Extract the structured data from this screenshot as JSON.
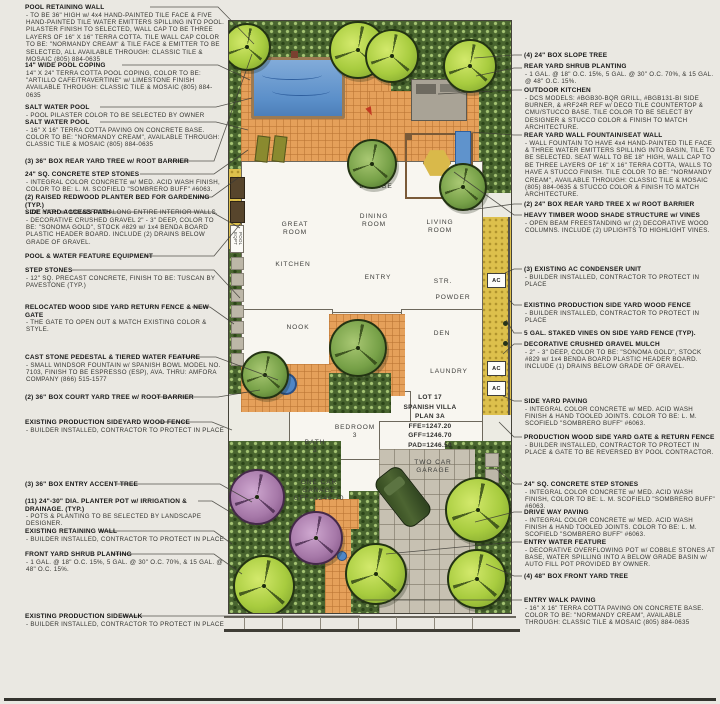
{
  "colors": {
    "paper": "#eae8e2",
    "ink": "#2b2b2b",
    "pool_blue": "#5b8fc9",
    "terra_cotta": "#e5a05a",
    "gravel_gold": "#ddc04c",
    "shrub_green": "#49652f",
    "tree_bright": "#a8cc3f",
    "tree_mid": "#76a047",
    "tree_purple": "#a678a8",
    "pave_gray": "#c7c1b2",
    "car_green": "#33491f"
  },
  "plan": {
    "rooms": {
      "great": "GREAT\nROOM",
      "lounge": "LOUNGE",
      "dining": "DINING\nROOM",
      "living": "LIVING\nROOM",
      "kitchen": "KITCHEN",
      "entry": "ENTRY",
      "stairs": "STR.",
      "powder": "POWDER",
      "nook": "NOOK",
      "den": "DEN",
      "laundry": "LAUNDRY",
      "bath": "BATH\n3",
      "bedroom": "BEDROOM\n3"
    },
    "lot_block": "LOT 17\nSPANISH VILLA\nPLAN 3A\nFFE=1247.20\nGFF=1246.70\nPAD=1246.50",
    "two_car": "TWO CAR\nGARAGE",
    "one_car": "ONE CAR\nGARAGE\nGFF=1246.70",
    "ac_label": "AC",
    "pool_eqpt_label": "POOL EQPT"
  },
  "left_annotations": [
    {
      "title": "POOL RETAINING WALL",
      "body": "- TO BE 36\" HIGH w/ 4x4 HAND-PAINTED TILE FACE & FIVE HAND-PAINTED TILE WATER EMITTERS SPILLING INTO POOL. PILASTER FINISH TO SELECTED, WALL CAP TO BE THREE LAYERS OF 16\" X 16\" TERRA COTTA. TILE WALL CAP COLOR TO BE: \"NORMANDY CREAM\" & TILE FACE & EMITTER TO BE SELECTED, ALL AVAILABLE THROUGH: CLASSIC TILE & MOSAIC (805) 884-0635"
    },
    {
      "title": "14\" WIDE POOL COPING",
      "body": "14\" X 24\" TERRA COTTA POOL COPING, COLOR TO BE: \"ARTILLO CAFE/TRAVERTINE\" w/ LIMESTONE FINISH AVAILABLE THROUGH: CLASSIC TILE & MOSAIC (805) 884-0635"
    },
    {
      "title": "SALT WATER POOL",
      "body": "- POOL PILASTER COLOR TO BE SELECTED BY OWNER"
    },
    {
      "title": "SALT WATER POOL",
      "body": "- 16\" X 16\" TERRA COTTA PAVING ON CONCRETE BASE. COLOR TO BE: \"NORMANDY CREAM\", AVAILABLE THROUGH: CLASSIC TILE & MOSAIC (805) 884-0635"
    },
    {
      "title": "(3) 36\" BOX REAR YARD TREE w/ ROOT BARRIER",
      "body": ""
    },
    {
      "title": "24\" SQ. CONCRETE STEP STONES",
      "body": "- INTEGRAL COLOR CONCRETE w/ MED. ACID WASH FINISH, COLOR TO BE: L. M. SCOFIELD \"SOMBRERO BUFF\" #6063."
    },
    {
      "title": "(2) RAISED REDWOOD PLANTER BED FOR GARDENING (TYP.)",
      "body": "- 24\" HIGH w/ MIRADRAIN ALONG ENTIRE INTERIOR WALLS."
    },
    {
      "title": "SIDE YARD ACCESS PATH",
      "body": "- DECORATIVE CRUSHED GRAVEL 2\" - 3\" DEEP, COLOR TO BE: \"SONOMA GOLD\", STOCK #829 w/ 1x4 BENDA BOARD PLASTIC HEADER BOARD. INCLUDE (2) DRAINS BELOW GRADE OF GRAVEL."
    },
    {
      "title": "POOL & WATER FEATURE EQUIPMENT",
      "body": ""
    },
    {
      "title": "STEP STONES",
      "body": "- 12\" SQ. PRECAST CONCRETE, FINISH TO BE: TUSCAN BY PAVESTONE (TYP.)"
    },
    {
      "title": "RELOCATED WOOD SIDE YARD RETURN FENCE & NEW GATE",
      "body": "- THE GATE TO OPEN OUT & MATCH EXISTING COLOR & STYLE."
    },
    {
      "title": "CAST STONE PEDESTAL & TIERED WATER FEATURE",
      "body": "- SMALL WINDSOR FOUNTAIN w/ SPANISH BOWL MODEL NO. 7103, FINISH TO BE ESPRESSO (ESP), AVA. THRU: AMFORA COMPANY (866) 515-1577"
    },
    {
      "title": "(2) 36\" BOX COURT YARD TREE w/ ROOT BARRIER",
      "body": ""
    },
    {
      "title": "EXISTING PRODUCTION SIDEYARD WOOD FENCE",
      "body": "- BUILDER INSTALLED, CONTRACTOR TO PROTECT IN PLACE"
    },
    {
      "title": "(3) 36\" BOX ENTRY ACCENT TREE",
      "body": ""
    },
    {
      "title": "(11) 24\"-30\" DIA. PLANTER POT w/ IRRIGATION & DRAINAGE. (TYP.)",
      "body": "- POTS & PLANTING TO BE SELECTED BY LANDSCAPE DESIGNER."
    },
    {
      "title": "EXISTING RETAINING WALL",
      "body": "- BUILDER INSTALLED, CONTRACTOR TO PROTECT IN PLACE"
    },
    {
      "title": "FRONT YARD SHRUB PLANTING",
      "body": "- 1 GAL. @ 18\" O.C. 15%, 5 GAL. @ 30\" O.C. 70%, & 15 GAL. @ 48\" O.C. 15%."
    },
    {
      "title": "EXISTING PRODUCTION SIDEWALK",
      "body": "- BUILDER INSTALLED, CONTRACTOR TO PROTECT IN PLACE"
    }
  ],
  "right_annotations": [
    {
      "title": "(4) 24\" BOX SLOPE TREE",
      "body": ""
    },
    {
      "title": "REAR YARD SHRUB PLANTING",
      "body": "- 1 GAL. @ 18\" O.C. 15%, 5 GAL. @ 30\" O.C. 70%, & 15 GAL. @ 48\" O.C. 15%."
    },
    {
      "title": "OUTDOOR KITCHEN",
      "body": "- DCS MODELS: #BGB30-BQR GRILL, #BGB131-BI SIDE BURNER, & #RF24R REF w/ DECO TILE COUNTERTOP & CMU/STUCCO BASE. TILE COLOR TO BE SELECT BY DESIGNER & STUCCO COLOR & FINISH TO MATCH ARCHITECTURE."
    },
    {
      "title": "REAR YARD WALL FOUNTAIN/SEAT WALL",
      "body": "- WALL FOUNTAIN TO HAVE 4x4 HAND-PAINTED TILE FACE & THREE WATER EMITTERS SPILLING INTO BASIN, TILE TO BE SELECTED. SEAT WALL TO BE 18\" HIGH, WALL CAP TO BE THREE LAYERS OF 16\" X 16\" TERRA COTTA, WALLS TO HAVE A STUCCO FINISH. TILE COLOR TO BE: \"NORMANDY CREAM\", AVAILABLE THROUGH: CLASSIC TILE & MOSAIC (805) 884-0635 & STUCCO COLOR & FINISH TO MATCH ARCHITECTURE."
    },
    {
      "title": "(2) 24\" BOX REAR YARD TREE X w/ ROOT BARRIER",
      "body": ""
    },
    {
      "title": "HEAVY TIMBER WOOD SHADE STRUCTURE w/ VINES",
      "body": "- OPEN BEAM FREESTANDING w/ (2) DECORATIVE WOOD COLUMNS. INCLUDE (2) UPLIGHTS TO HIGHLIGHT VINES."
    },
    {
      "title": "(3) EXISTING AC CONDENSER UNIT",
      "body": "- BUILDER INSTALLED, CONTRACTOR TO PROTECT IN PLACE"
    },
    {
      "title": "EXISTING PRODUCTION SIDE YARD WOOD FENCE",
      "body": "- BUILDER INSTALLED, CONTRACTOR TO PROTECT IN PLACE"
    },
    {
      "title": "5 GAL. STAKED VINES ON SIDE YARD FENCE (TYP).",
      "body": ""
    },
    {
      "title": "DECORATIVE CRUSHED GRAVEL MULCH",
      "body": "- 2\" - 3\" DEEP, COLOR TO BE: \"SONOMA GOLD\", STOCK #829 w/ 1x4 BENDA BOARD PLASTIC HEADER BOARD. INCLUDE (1) DRAINS BELOW GRADE OF GRAVEL."
    },
    {
      "title": "SIDE YARD PAVING",
      "body": "- INTEGRAL COLOR CONCRETE w/ MED. ACID WASH FINISH & HAND TOOLED JOINTS. COLOR TO BE: L. M. SCOFIELD \"SOMBRERO BUFF\" #6063."
    },
    {
      "title": "PRODUCTION WOOD SIDE YARD GATE & RETURN FENCE",
      "body": "- BUILDER INSTALLED, CONTRACTOR TO PROTECT IN PLACE & GATE TO BE REVERSED BY POOL CONTRACTOR."
    },
    {
      "title": "24\" SQ. CONCRETE STEP STONES",
      "body": "- INTEGRAL COLOR CONCRETE w/ MED. ACID WASH FINISH, COLOR TO BE: L. M. SCOFIELD \"SOMBRERO BUFF\" #6063."
    },
    {
      "title": "DRIVE WAY PAVING",
      "body": "- INTEGRAL COLOR CONCRETE w/ MED. ACID WASH FINISH & HAND TOOLED JOINTS. COLOR TO BE: L. M. SCOFIELD \"SOMBRERO BUFF\" #6063."
    },
    {
      "title": "ENTRY WATER FEATURE",
      "body": "- DECORATIVE OVERFLOWING POT w/ COBBLE STONES AT BASE, WATER SPILLING INTO A BELOW GRADE BASIN w/ AUTO FILL POT PROVIDED BY OWNER."
    },
    {
      "title": "(4) 48\" BOX FRONT YARD TREE",
      "body": ""
    },
    {
      "title": "ENTRY WALK PAVING",
      "body": "- 16\" X 16\" TERRA COTTA PAVING ON CONCRETE BASE. COLOR TO BE: \"NORMANDY CREAM\", AVAILABLE THROUGH: CLASSIC TILE & MOSAIC (805) 884-0635"
    }
  ]
}
